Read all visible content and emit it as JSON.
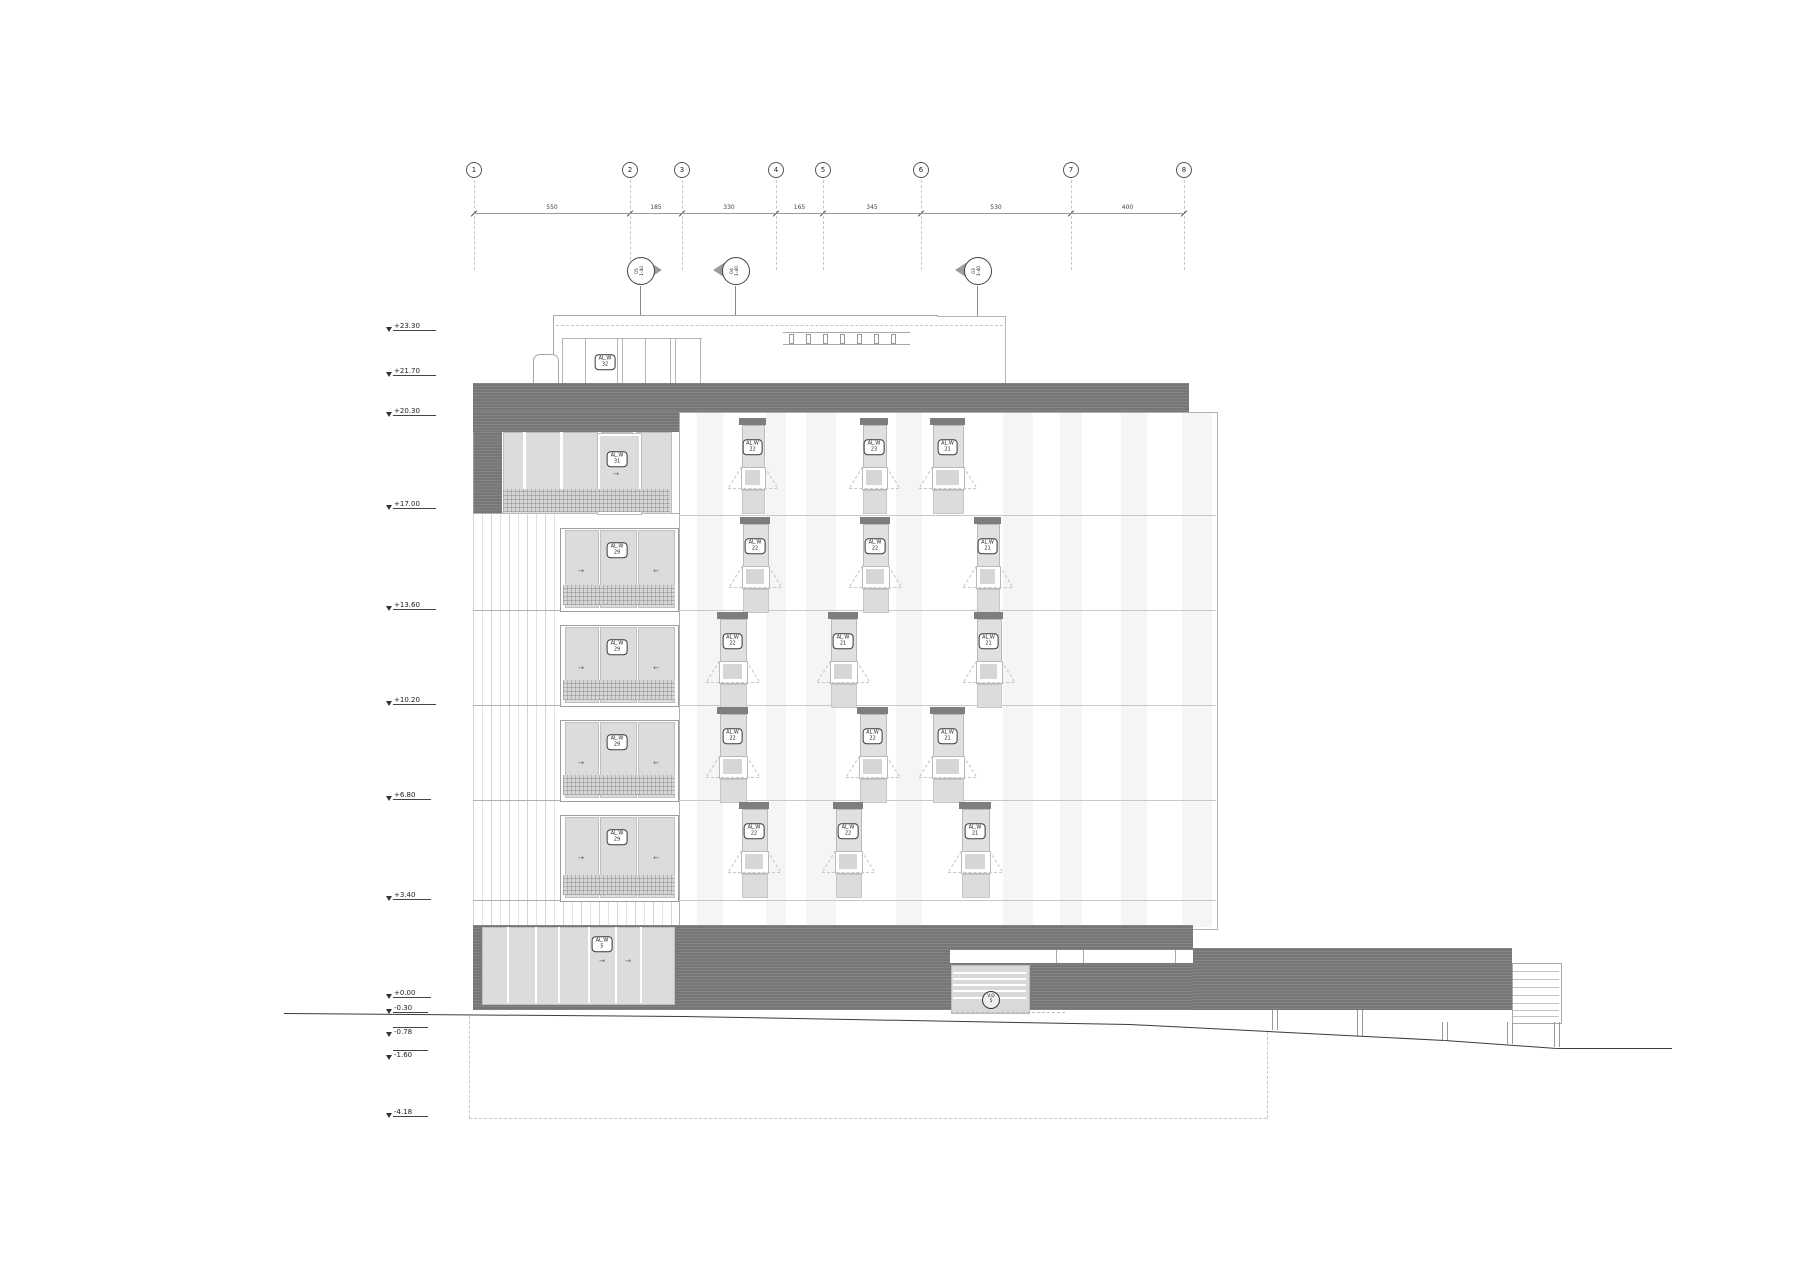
{
  "drawing": {
    "grid": {
      "bubbles": [
        "1",
        "2",
        "3",
        "4",
        "5",
        "6",
        "7",
        "8"
      ],
      "dimensions": [
        "550",
        "185",
        "330",
        "165",
        "345",
        "530",
        "400"
      ]
    },
    "levels": [
      {
        "label": "+23.30"
      },
      {
        "label": "+21.70"
      },
      {
        "label": "+20.30"
      },
      {
        "label": "+17.00"
      },
      {
        "label": "+13.60"
      },
      {
        "label": "+10.20"
      },
      {
        "label": "+6.80"
      },
      {
        "label": "+3.40"
      },
      {
        "label": "+0.00"
      },
      {
        "label": "-0.30"
      },
      {
        "label": "-0.78"
      },
      {
        "label": "-1.60"
      },
      {
        "label": "-4.18"
      }
    ],
    "section_markers": [
      {
        "line1": "05",
        "line2": "1-40"
      },
      {
        "line1": "04",
        "line2": "1-40"
      },
      {
        "line1": "03",
        "line2": "1-40"
      }
    ],
    "tags": {
      "penthouse": {
        "line1": "AL.W",
        "line2": "32"
      },
      "garage": {
        "line1": "V.D",
        "line2": "5"
      }
    },
    "left_tags": [
      {
        "line1": "AL.W",
        "line2": "31"
      },
      {
        "line1": "AL.W",
        "line2": "29"
      },
      {
        "line1": "AL.W",
        "line2": "29"
      },
      {
        "line1": "AL.W",
        "line2": "29"
      },
      {
        "line1": "AL.W",
        "line2": "29"
      },
      {
        "line1": "AL.W",
        "line2": "5"
      }
    ],
    "facade_rows": [
      {
        "labels": [
          {
            "line1": "AL.W",
            "line2": "22"
          },
          {
            "line1": "AL.W",
            "line2": "23"
          },
          {
            "line1": "AL.W",
            "line2": "21"
          }
        ]
      },
      {
        "labels": [
          {
            "line1": "AL.W",
            "line2": "22"
          },
          {
            "line1": "AL.W",
            "line2": "22"
          },
          {
            "line1": "AL.W",
            "line2": "21"
          }
        ]
      },
      {
        "labels": [
          {
            "line1": "AL.W",
            "line2": "22"
          },
          {
            "line1": "AL.W",
            "line2": "21"
          },
          {
            "line1": "AL.W",
            "line2": "21"
          }
        ]
      },
      {
        "labels": [
          {
            "line1": "AL.W",
            "line2": "22"
          },
          {
            "line1": "AL.W",
            "line2": "22"
          },
          {
            "line1": "AL.W",
            "line2": "21"
          }
        ]
      },
      {
        "labels": [
          {
            "line1": "AL.W",
            "line2": "22"
          },
          {
            "line1": "AL.W",
            "line2": "22"
          },
          {
            "line1": "AL.W",
            "line2": "21"
          }
        ]
      }
    ]
  }
}
